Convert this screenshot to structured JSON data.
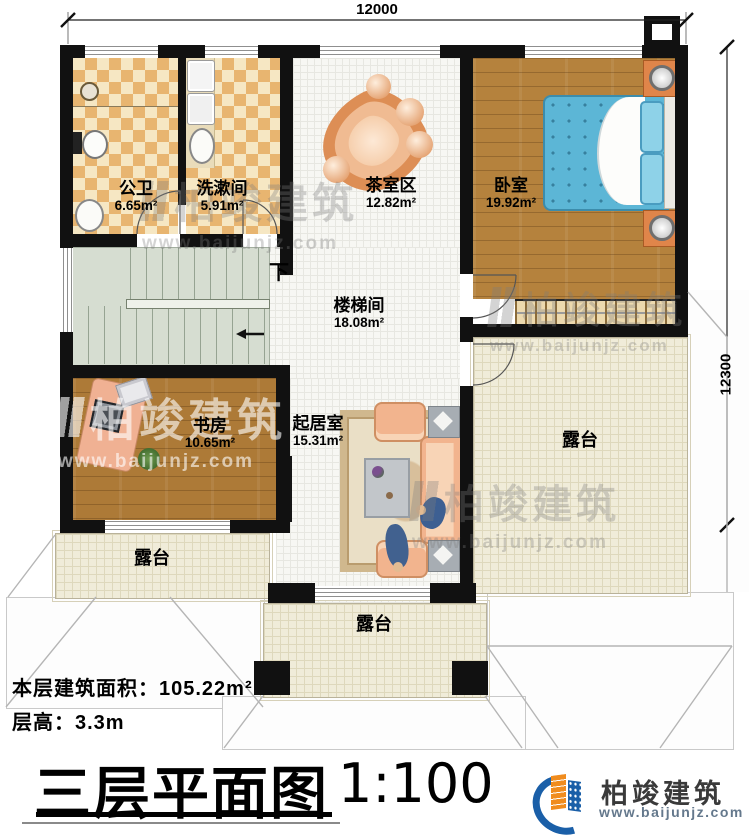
{
  "dimensions": {
    "width_mm": "12000",
    "height_mm": "12300"
  },
  "rooms": [
    {
      "name": "公卫",
      "area": "6.65m²"
    },
    {
      "name": "洗漱间",
      "area": "5.91m²"
    },
    {
      "name": "茶室区",
      "area": "12.82m²"
    },
    {
      "name": "卧室",
      "area": "19.92m²"
    },
    {
      "name": "楼梯间",
      "area": "18.08m²"
    },
    {
      "name": "书房",
      "area": "10.65m²"
    },
    {
      "name": "起居室",
      "area": "15.31m²"
    },
    {
      "name": "露台"
    },
    {
      "name": "露台"
    },
    {
      "name": "露台"
    }
  ],
  "stairs": {
    "direction_label": "下"
  },
  "info": {
    "building_area_label": "本层建筑面积：",
    "building_area_value": "105.22m²",
    "floor_height_label": "层高：",
    "floor_height_value": "3.3m"
  },
  "title": {
    "plan_name": "三层平面图",
    "scale": "1:100"
  },
  "brand": {
    "name": "柏竣建筑",
    "website": "www.baijunjz.com"
  },
  "colors": {
    "wall": "#111111",
    "wood_floor": "#b5823d",
    "tile_dark": "#e8b570",
    "tile_light": "#f6e7c3",
    "stair_floor": "#d6ddd1",
    "terrace_floor": "#f0ecd9",
    "hall_floor": "#f7f7f3",
    "bed_blue": "#5cb6d6",
    "sofa_peach": "#f2b48e",
    "brand_blue": "#1a5fa8",
    "brand_orange": "#f08c1e"
  }
}
